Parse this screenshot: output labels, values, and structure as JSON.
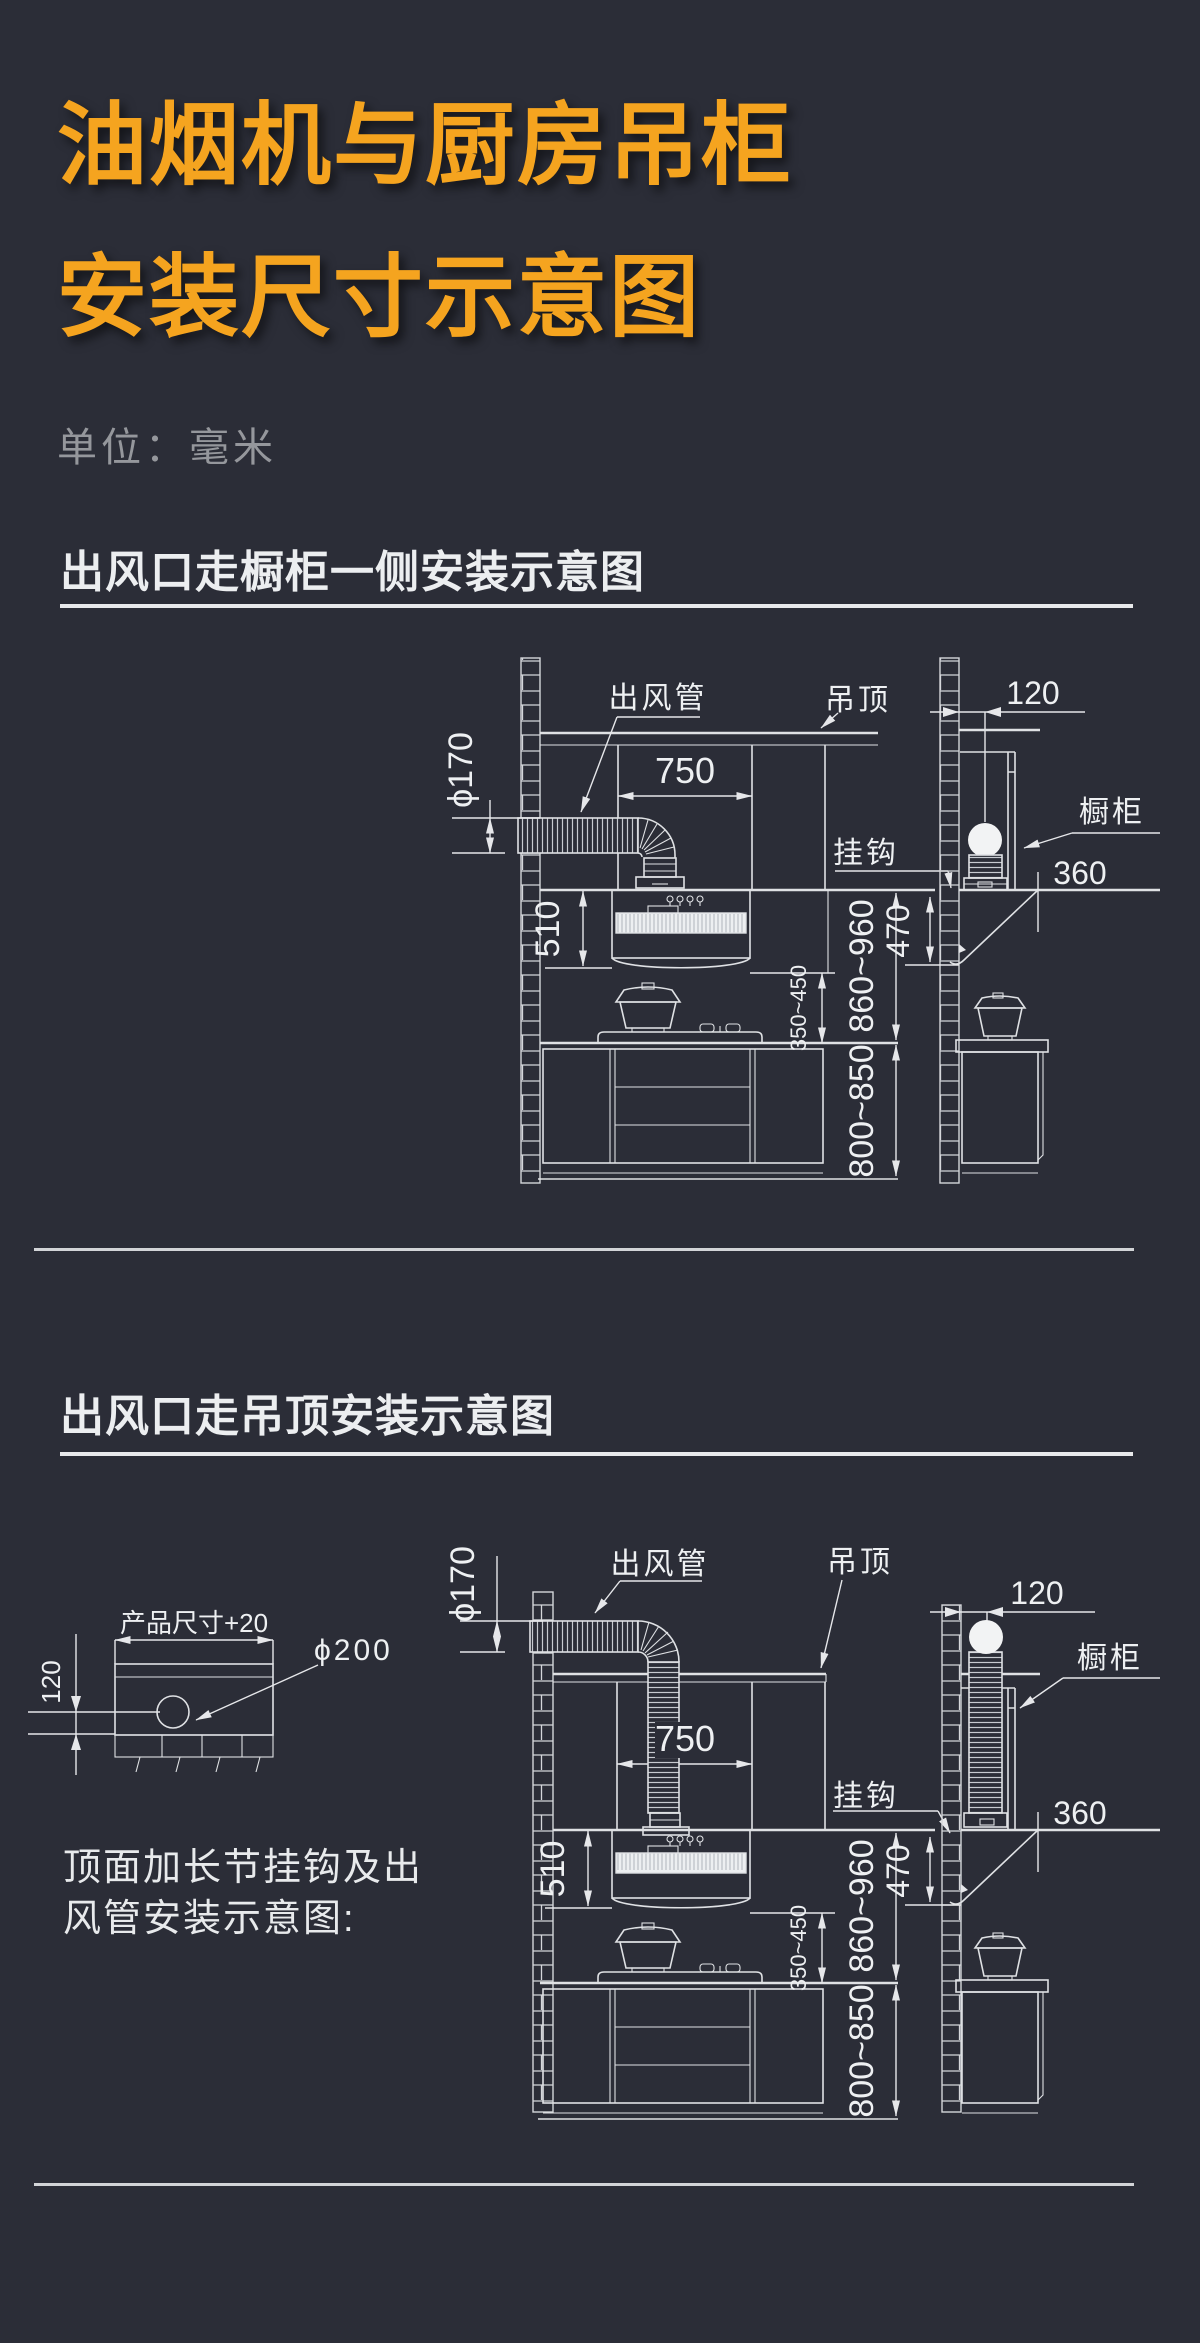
{
  "page": {
    "title_line1": "油烟机与厨房吊柜",
    "title_line2": "安装尺寸示意图",
    "unit_label": "单位：毫米"
  },
  "section1": {
    "heading": "出风口走橱柜一侧安装示意图"
  },
  "section2": {
    "heading": "出风口走吊顶安装示意图",
    "caption_line1": "顶面加长节挂钩及出",
    "caption_line2": "风管安装示意图:"
  },
  "d1": {
    "duct": "出风管",
    "ceiling": "吊顶",
    "hook": "挂钩",
    "cabinet": "橱柜",
    "dia": "ϕ170",
    "w": "750",
    "hood_h": "510",
    "gap": "120",
    "depth": "360",
    "hook_h": "470",
    "hob": "350~450",
    "hang": "860~960",
    "counter": "800~850"
  },
  "d2": {
    "duct": "出风管",
    "ceiling": "吊顶",
    "hook": "挂钩",
    "cabinet": "橱柜",
    "dia": "ϕ170",
    "w": "750",
    "hood_h": "510",
    "gap": "120",
    "depth": "360",
    "hook_h": "470",
    "hob": "350~450",
    "hang": "860~960",
    "counter": "800~850",
    "product": "产品尺寸+20",
    "hole": "ϕ200",
    "offset": "120"
  },
  "colors": {
    "bg": "#2b2d37",
    "accent": "#f5a41f",
    "line": "#dfe1e4",
    "muted": "#95979c"
  }
}
